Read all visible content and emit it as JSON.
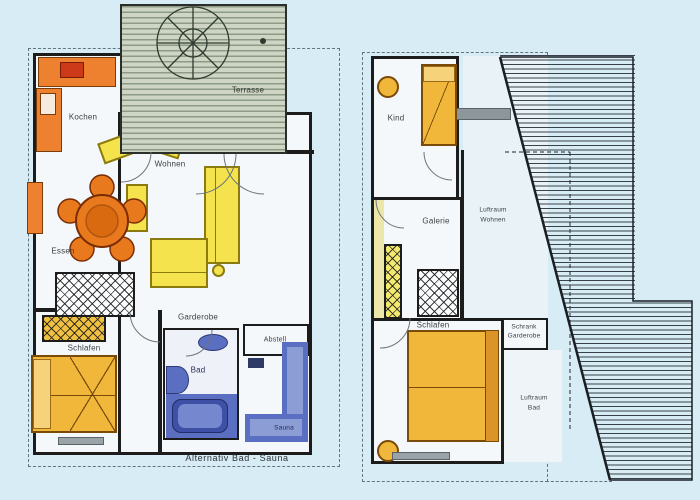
{
  "document": {
    "type": "floor-plan-scan",
    "background_color": "#d7ecf4",
    "wall_color": "#1c1c1c",
    "accent_colors": {
      "kitchen_orange": "#ee8130",
      "sofa_yellow": "#f4e34d",
      "bed_amber": "#f0b73a",
      "bath_blue": "#5b6fc2",
      "tub_blue": "#3e50a6",
      "deck_green_gray": "#cfd5c5"
    }
  },
  "left_plan": {
    "name": "ground-floor-plan",
    "labels": {
      "terrasse": "Terrasse",
      "kochen": "Kochen",
      "wohnen": "Wohnen",
      "essen": "Essen",
      "schlafen": "Schlafen",
      "garderobe": "Garderobe",
      "bad": "Bad",
      "abstell": "Abstell",
      "sauna": "Sauna",
      "note": "Alternativ Bad - Sauna"
    }
  },
  "right_plan": {
    "name": "upper-floor-plan",
    "labels": {
      "kind": "Kind",
      "galerie": "Galerie",
      "luftraum_wohnen_line1": "Luftraum",
      "luftraum_wohnen_line2": "Wohnen",
      "schlafen": "Schlafen",
      "schrank_line1": "Schrank",
      "schrank_line2": "Garderobe",
      "luftraum_bad_line1": "Luftraum",
      "luftraum_bad_line2": "Bad"
    }
  }
}
